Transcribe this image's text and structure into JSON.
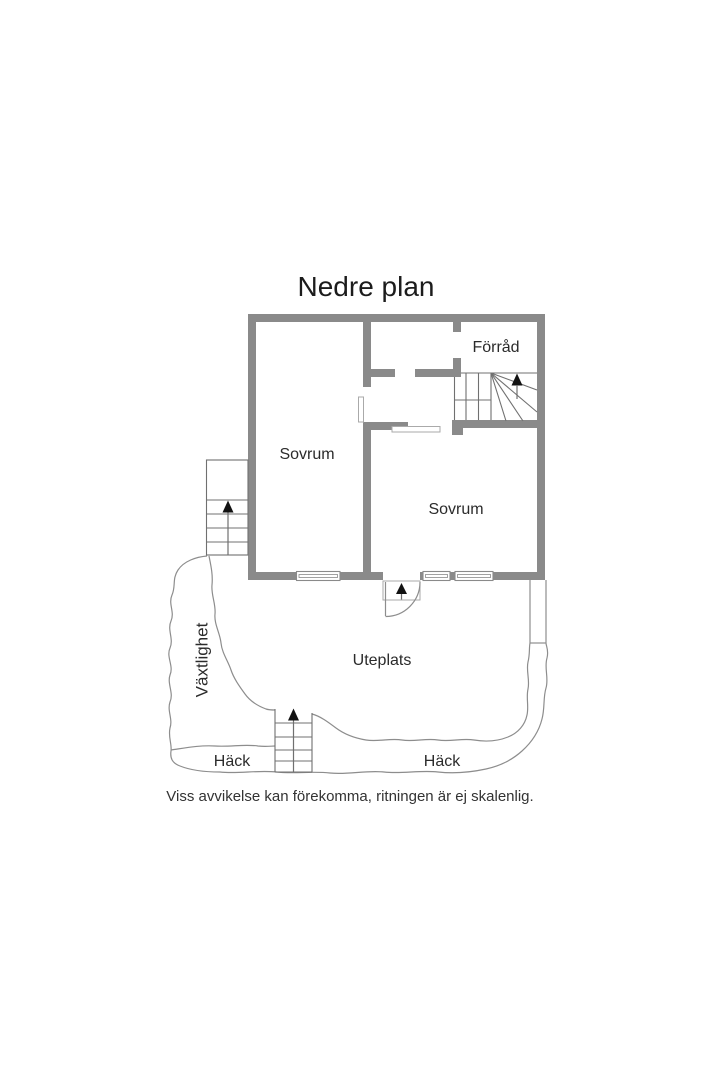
{
  "title": "Nedre plan",
  "disclaimer": "Viss avvikelse kan förekomma, ritningen är ej skalenlig.",
  "labels": {
    "forrad": "Förråd",
    "sovrum_left": "Sovrum",
    "sovrum_right": "Sovrum",
    "uteplats": "Uteplats",
    "vaxtlighet": "Växtlighet",
    "hack_left": "Häck",
    "hack_right": "Häck"
  },
  "icons": {
    "up_arrow": "filled-triangle-up"
  },
  "colors": {
    "background": "#ffffff",
    "wall": "#8a8a8a",
    "line": "#8d8d8d",
    "stair_line": "#707070",
    "light_line": "#aaaaaa",
    "text": "#2b2b2b",
    "title_text": "#1c1c1c",
    "arrow": "#121212"
  }
}
